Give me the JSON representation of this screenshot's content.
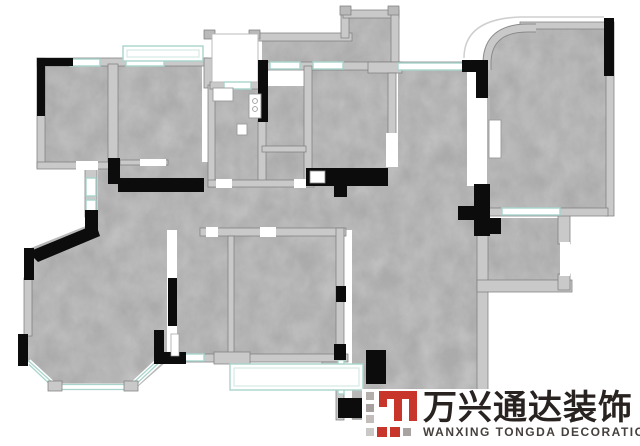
{
  "page": {
    "width": 640,
    "height": 446,
    "background": "#ffffff"
  },
  "floor_plan": {
    "description": "Residential apartment floor plan rendered with gray concrete-textured floors",
    "colors": {
      "floor_concrete": "#a9a9a9",
      "wall_fill": "#c9c9c9",
      "wall_edge": "#7f7f7f",
      "accent_wall_black": "#0c0c0c",
      "window_glass_teal": "#a9d4cb",
      "window_frame_white": "#ffffff",
      "outside_background": "#ffffff"
    },
    "features": [
      "top-balcony-railing",
      "entry-light-well",
      "kitchen-bath-core",
      "curved-corner-bedroom-top-right",
      "living-room-bay-window-bottom-left",
      "bottom-balcony-railing",
      "black-feature-walls"
    ]
  },
  "logo": {
    "title_cn": "万兴通达装饰",
    "title_en": "WANXING TONGDA DECORATION",
    "mark_colors": {
      "red": "#c8362b",
      "gray": "#a8a2a0",
      "light_gray": "#c9c5c3"
    },
    "text_color": "#282320"
  }
}
